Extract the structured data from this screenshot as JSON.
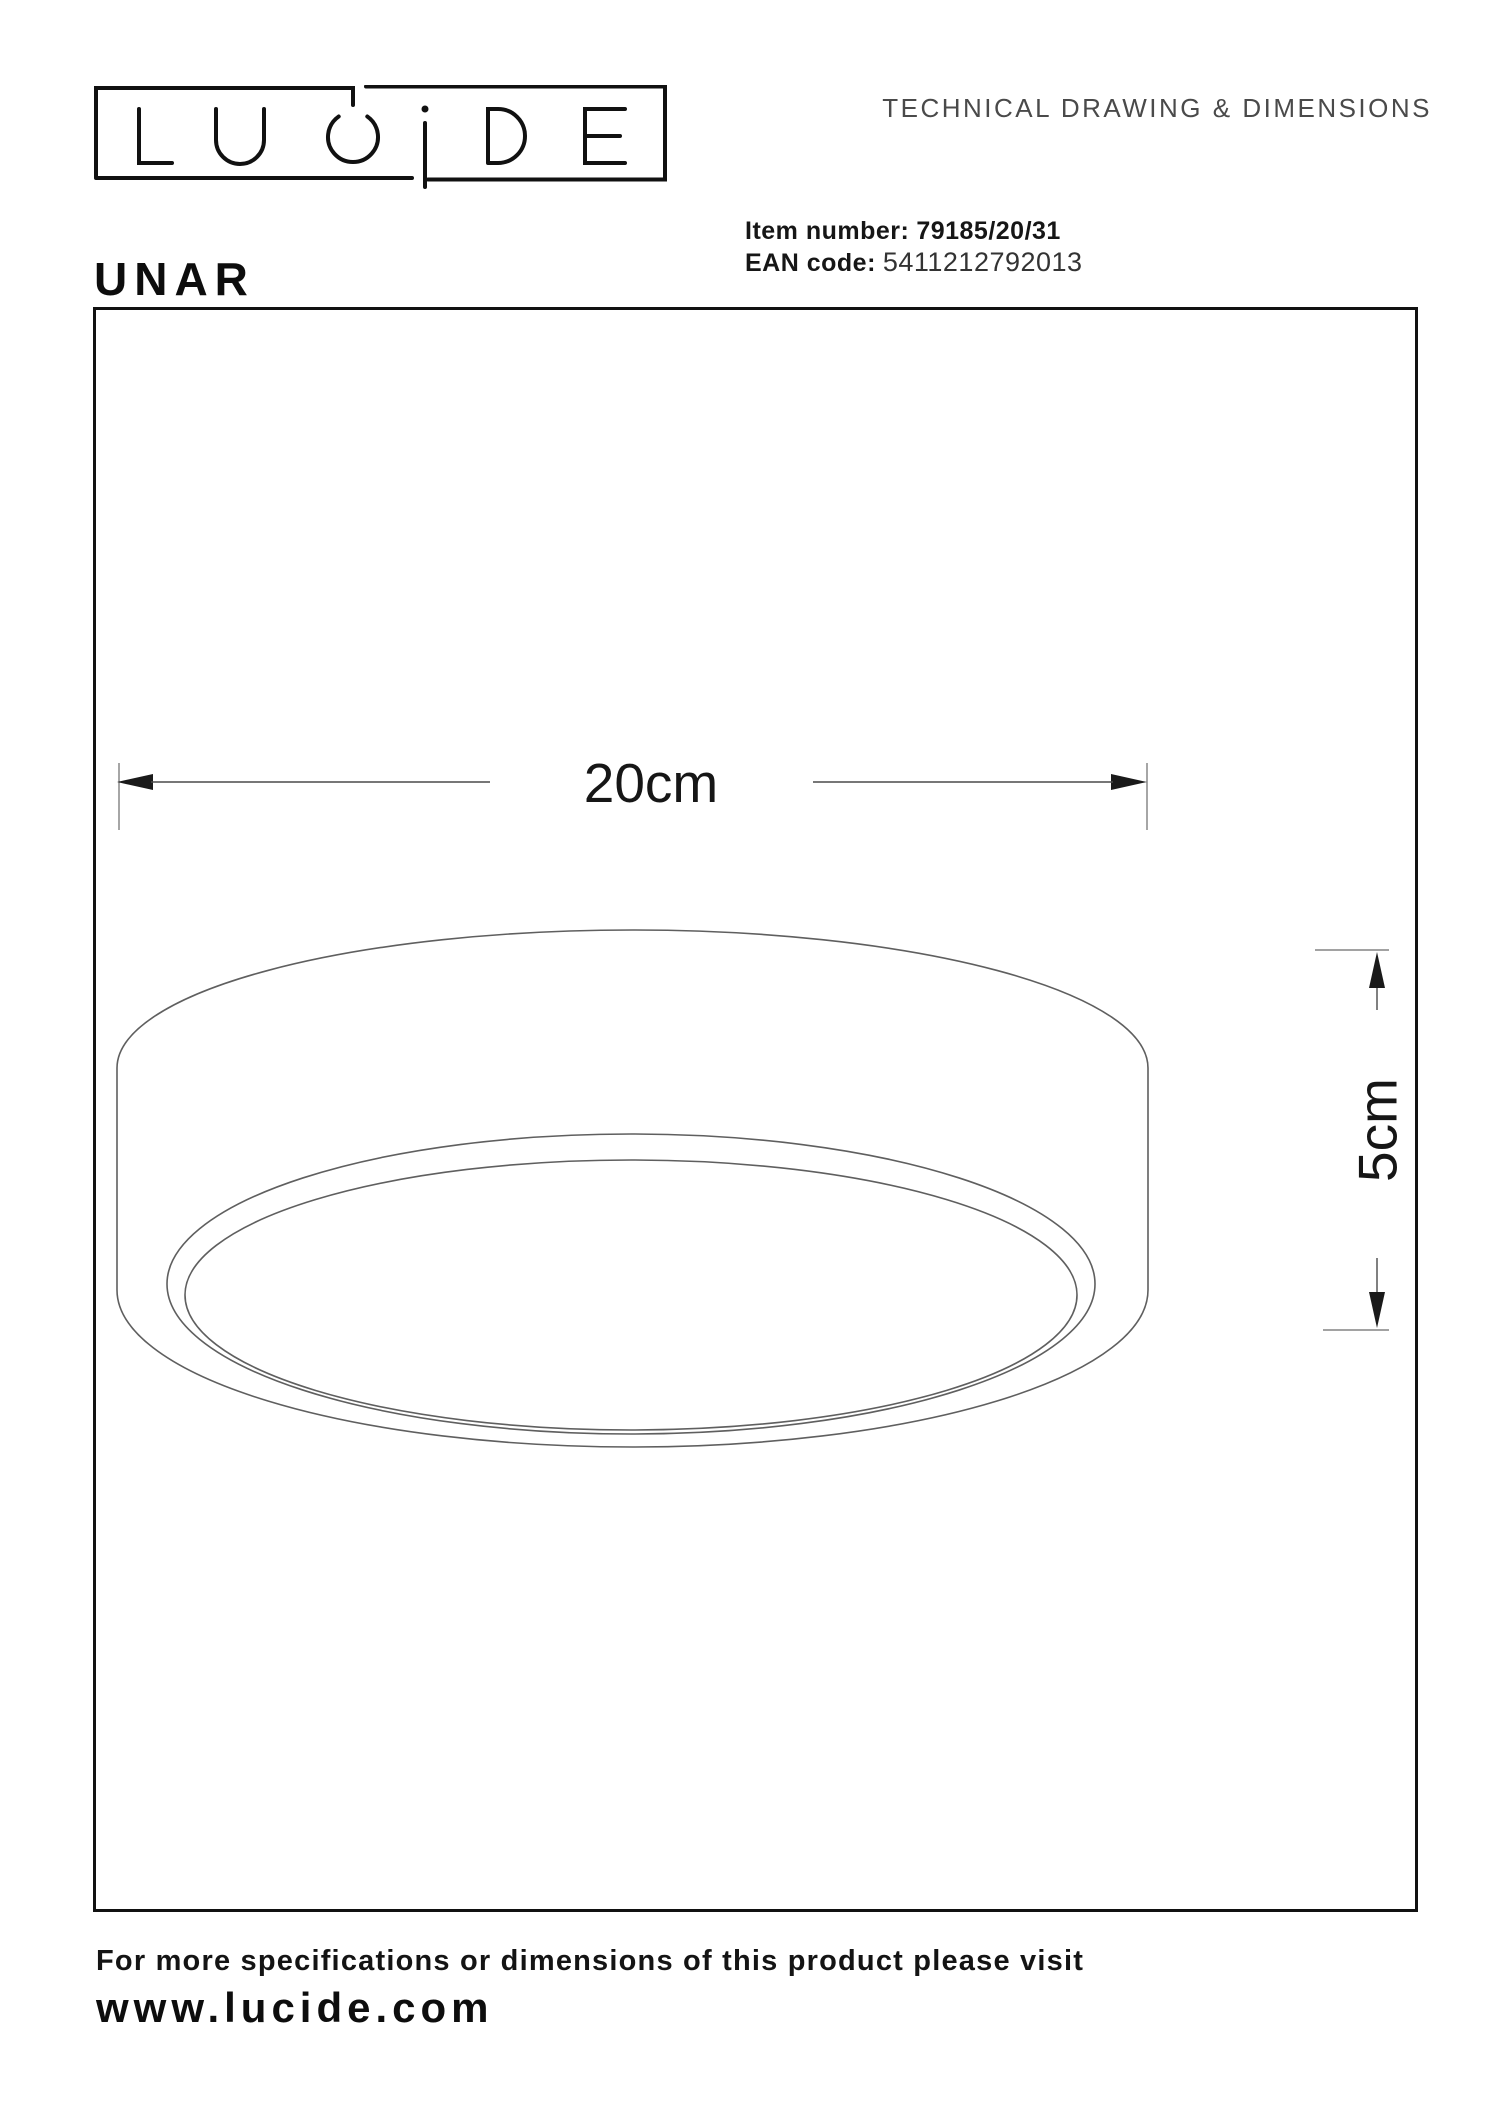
{
  "brand": "LUCIDE",
  "header": {
    "title": "TECHNICAL DRAWING & DIMENSIONS"
  },
  "product": {
    "name": "UNAR",
    "item_label": "Item number:",
    "item_value": "79185/20/31",
    "ean_label": "EAN code:",
    "ean_value": "5411212792013"
  },
  "drawing": {
    "width_label": "20cm",
    "height_label": "5cm"
  },
  "footer": {
    "note": "For more specifications or dimensions of this product please visit",
    "url": "www.lucide.com"
  },
  "colors": {
    "ink": "#111111",
    "drawing_line": "#5f5f5f",
    "dimension_line": "#4a4a4a",
    "muted_text": "#4a4a4a"
  }
}
